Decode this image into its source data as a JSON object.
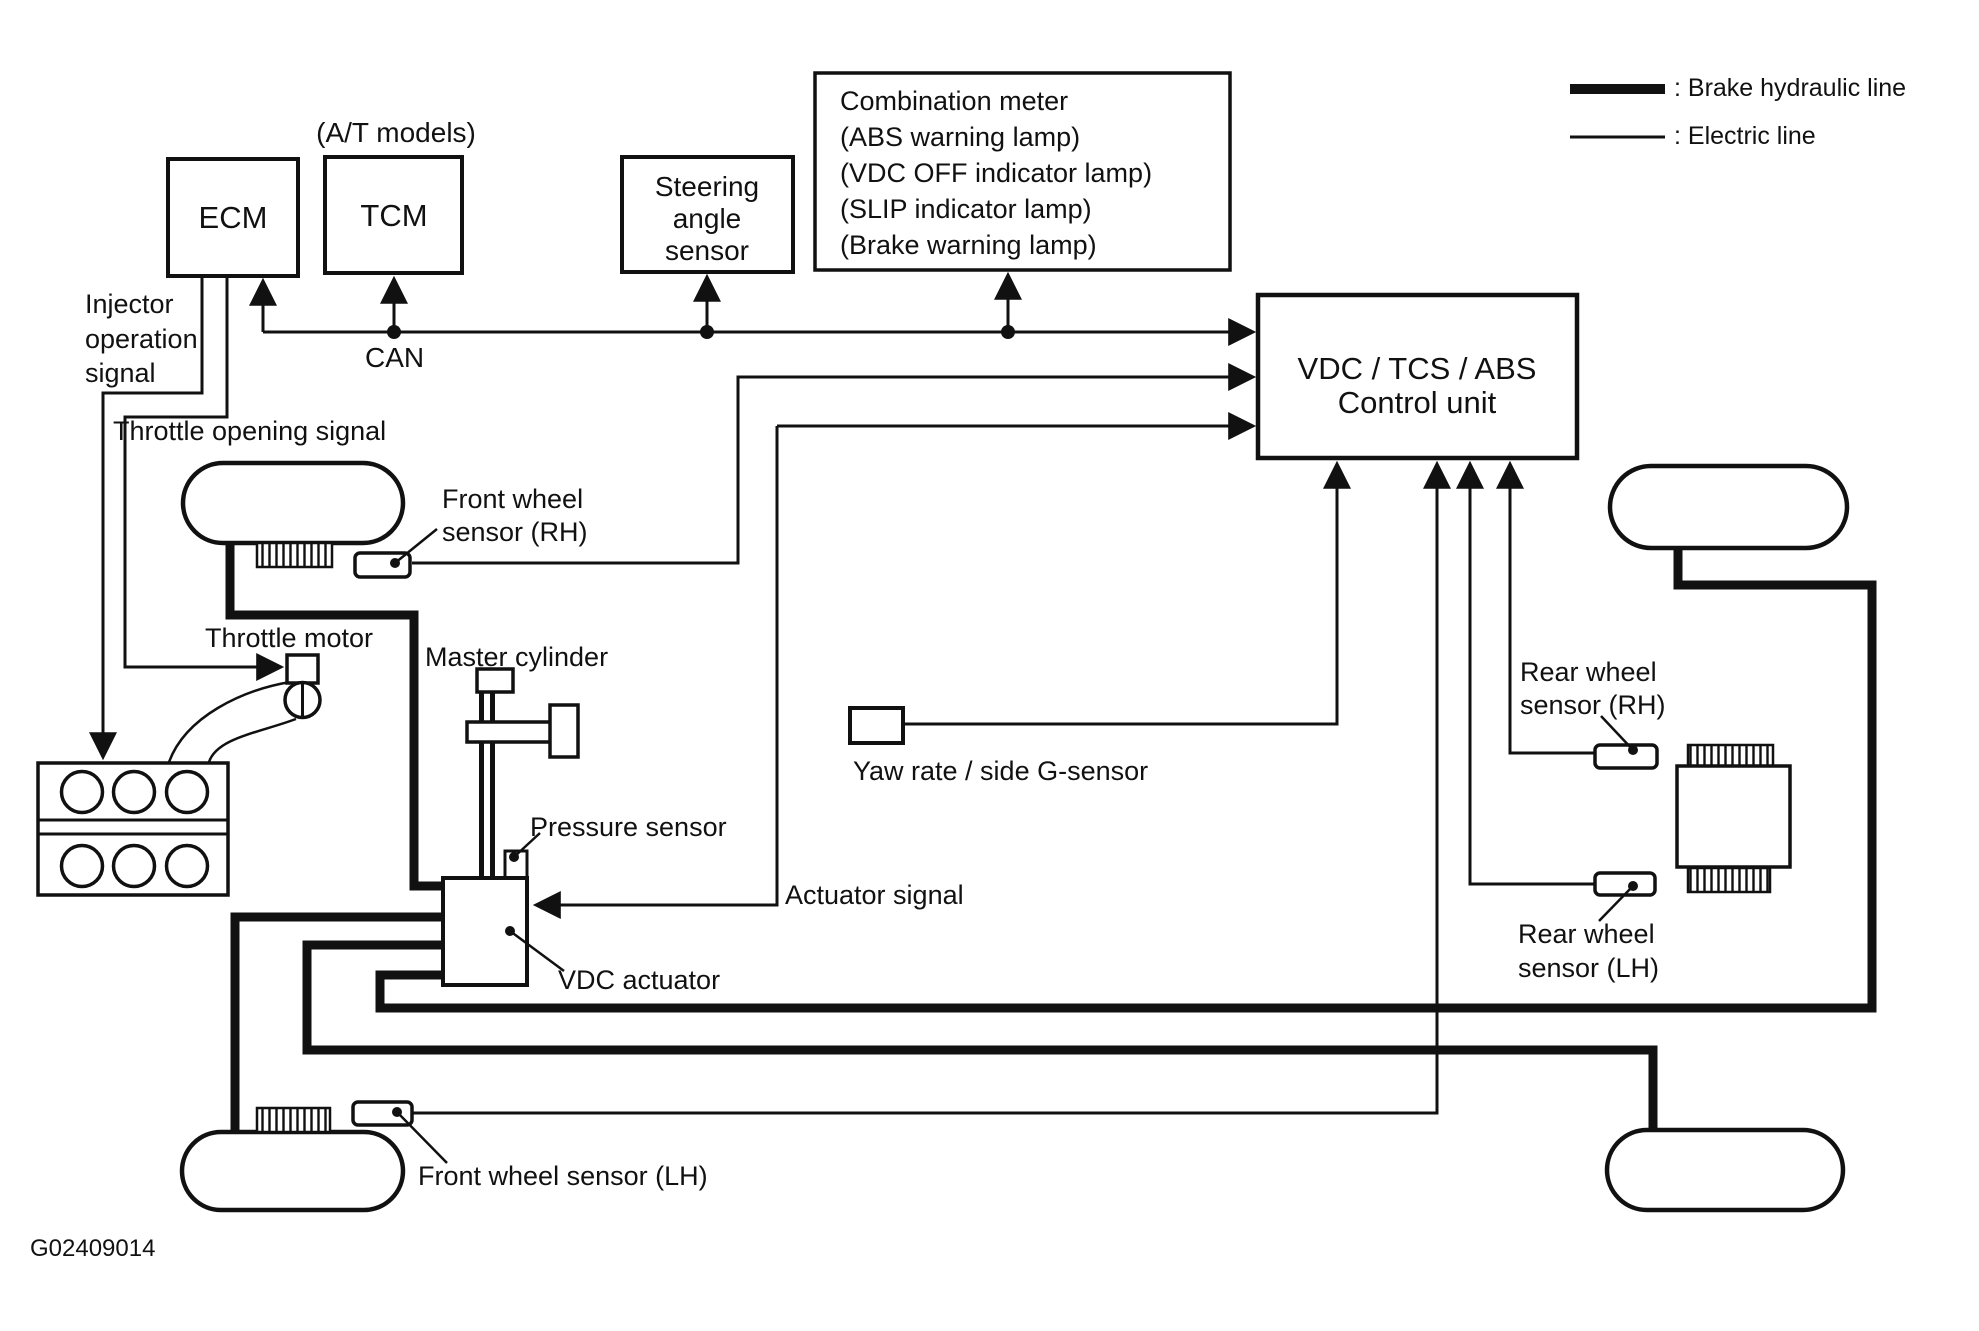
{
  "diagram": {
    "figure_id": "G02409014",
    "legend": {
      "brake": ": Brake hydraulic line",
      "electric": ": Electric line"
    },
    "boxes": {
      "ecm": "ECM",
      "tcm": "TCM",
      "tcm_note": "(A/T models)",
      "steering": {
        "l1": "Steering",
        "l2": "angle",
        "l3": "sensor"
      },
      "combination": {
        "l1": "Combination meter",
        "l2": "(ABS warning lamp)",
        "l3": "(VDC OFF indicator lamp)",
        "l4": "(SLIP indicator lamp)",
        "l5": "(Brake warning lamp)"
      },
      "control": {
        "l1": "VDC / TCS / ABS",
        "l2": "Control unit"
      }
    },
    "labels": {
      "injector": {
        "l1": "Injector",
        "l2": "operation",
        "l3": "signal"
      },
      "throttle_opening": "Throttle opening signal",
      "can": "CAN",
      "front_rh": {
        "l1": "Front wheel",
        "l2": "sensor (RH)"
      },
      "throttle_motor": "Throttle motor",
      "master_cylinder": "Master cylinder",
      "pressure_sensor": "Pressure sensor",
      "actuator_signal": "Actuator signal",
      "vdc_actuator": "VDC actuator",
      "yaw": "Yaw rate / side G-sensor",
      "rear_rh": {
        "l1": "Rear wheel",
        "l2": "sensor (RH)"
      },
      "rear_lh": {
        "l1": "Rear wheel",
        "l2": "sensor (LH)"
      },
      "front_lh": "Front wheel sensor (LH)"
    },
    "colors": {
      "ink": "#111111",
      "background": "#ffffff"
    }
  }
}
